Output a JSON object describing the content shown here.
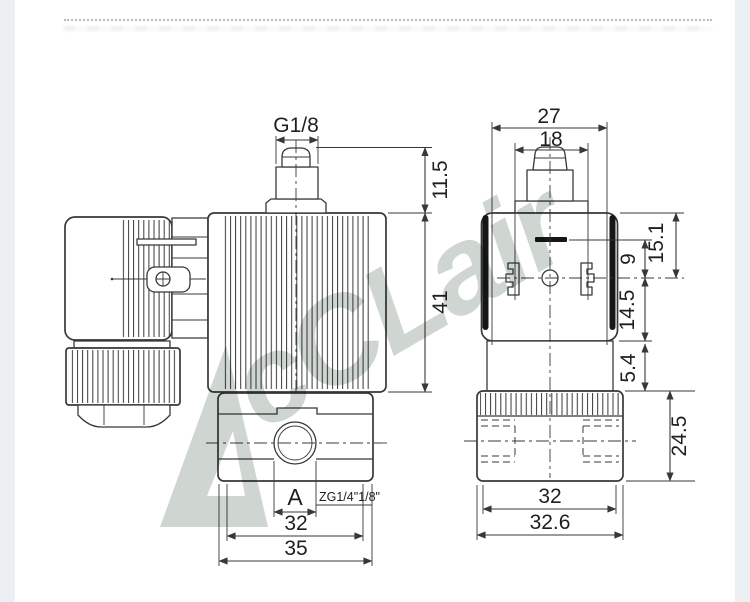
{
  "colors": {
    "line": "#383838",
    "black": "#161616",
    "watermark": "#cfd6d2",
    "margin": "#ecf0f2"
  },
  "watermark": {
    "text": "cCLair"
  },
  "left_view": {
    "port_thread_label": "G1/8",
    "dim_fitting_height": "11.5",
    "dim_coil_height": "41",
    "port_label": "A",
    "thread_note": "ZG1/4\"1/8\"",
    "dim_body_width": "32",
    "dim_body_width_overall": "35"
  },
  "right_view": {
    "dim_width_overall": "27",
    "dim_connector_width": "18",
    "dim_top_to_center": "15.1",
    "dim_slot_to_center": "9",
    "dim_center_to_bottom": "14.5",
    "dim_neck_height": "5.4",
    "dim_body_height": "24.5",
    "dim_body_width": "32",
    "dim_body_width_overall": "32.6"
  }
}
